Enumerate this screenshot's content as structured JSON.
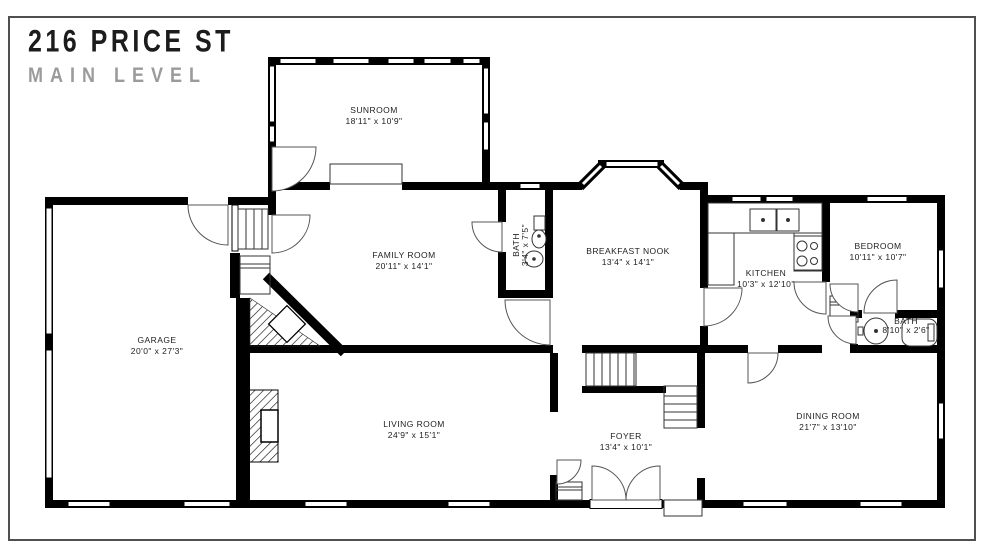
{
  "title": {
    "address": "216 PRICE ST",
    "level": "MAIN LEVEL"
  },
  "rooms": {
    "sunroom": {
      "name": "SUNROOM",
      "dims": "18'11\" x 10'9\""
    },
    "family_room": {
      "name": "FAMILY ROOM",
      "dims": "20'11\" x 14'1\""
    },
    "bath_small": {
      "name": "BATH",
      "dims": "3'4\" x 7'5\""
    },
    "breakfast_nook": {
      "name": "BREAKFAST NOOK",
      "dims": "13'4\" x 14'1\""
    },
    "kitchen": {
      "name": "KITCHEN",
      "dims": "10'3\" x 12'10\""
    },
    "bedroom": {
      "name": "BEDROOM",
      "dims": "10'11\" x 10'7\""
    },
    "bath_hall": {
      "name": "BATH",
      "dims": "8'10\" x 2'6\""
    },
    "garage": {
      "name": "GARAGE",
      "dims": "20'0\" x 27'3\""
    },
    "living_room": {
      "name": "LIVING ROOM",
      "dims": "24'9\" x 15'1\""
    },
    "foyer": {
      "name": "FOYER",
      "dims": "13'4\" x 10'1\""
    },
    "dining_room": {
      "name": "DINING ROOM",
      "dims": "21'7\" x 13'10\""
    }
  },
  "colors": {
    "wall": "#000000",
    "title_primary": "#1c1c1c",
    "title_secondary": "#9b9b9b",
    "frame": "#4f4f4f",
    "thin_line": "#3f3f3f",
    "background": "#ffffff"
  }
}
